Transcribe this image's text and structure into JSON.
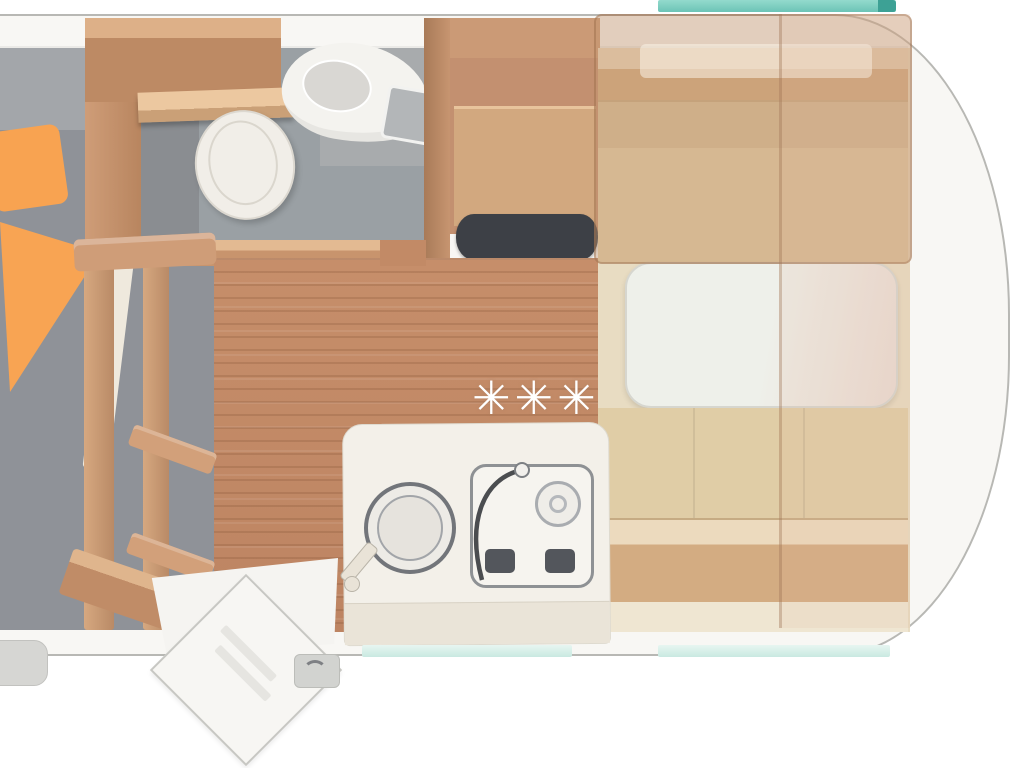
{
  "diagram": {
    "type": "caravan-floor-plan-top-view",
    "floor_markers": {
      "stars": [
        "✳",
        "✳",
        "✳"
      ]
    },
    "palette": {
      "shell_white": "#f8f7f4",
      "outline_gray": "#b8b8b4",
      "teal_accent": "#6cc4b6",
      "teal_dark": "#3da195",
      "mint_window": "#c9e9e1",
      "furniture_wood": "#c8966f",
      "floor_wood": "#c28a66",
      "bed_gray": "#8f9298",
      "pillow_orange": "#f8a351",
      "bath_gray": "#9aa0a4",
      "seat_beige": "#e0cda6",
      "bunk_overlay": "rgba(196,150,112,0.42)",
      "counter_white": "#f3f0e9",
      "dark_worktop": "#3d4046",
      "fixture_white": "#f1eee8"
    },
    "areas": [
      {
        "name": "double-bed"
      },
      {
        "name": "wardrobe"
      },
      {
        "name": "bathroom-with-toilet-and-basin"
      },
      {
        "name": "kitchen-tall-unit"
      },
      {
        "name": "kitchen-counter-sink-stove"
      },
      {
        "name": "dinette-with-table"
      },
      {
        "name": "entry-door-open"
      }
    ]
  }
}
